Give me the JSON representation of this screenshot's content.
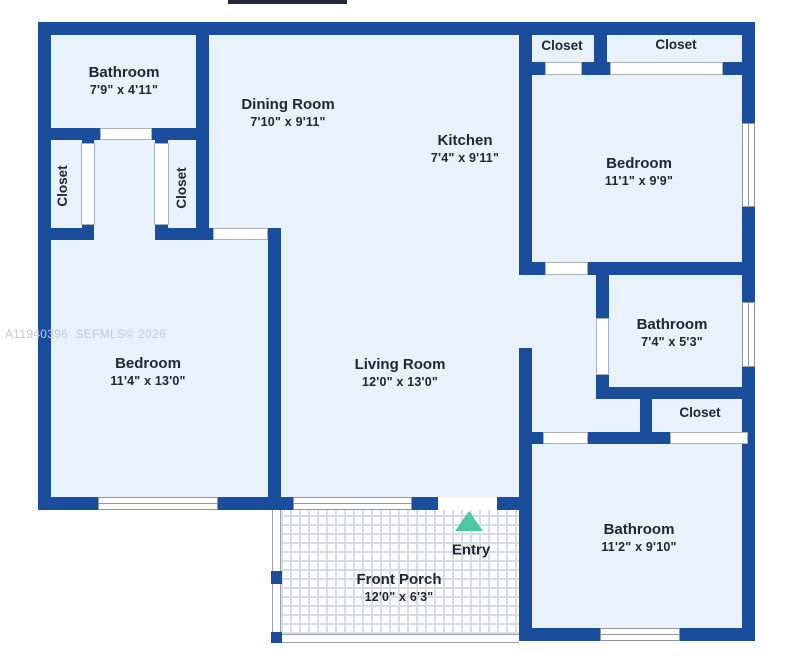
{
  "watermark": "A11940396  SEFMLS© 2026",
  "entry": {
    "label": "Entry"
  },
  "icons": {
    "entry_arrow": "triangle-up"
  },
  "colors": {
    "wall": "#1a4e9c",
    "floor": "#e9f1fa",
    "entry_arrow": "#4ec7a5",
    "label_text": "#202737"
  },
  "rooms": {
    "bathroom_top_left": {
      "name": "Bathroom",
      "dims": "7'9\" x 4'11\""
    },
    "dining_room": {
      "name": "Dining Room",
      "dims": "7'10\" x 9'11\""
    },
    "kitchen": {
      "name": "Kitchen",
      "dims": "7'4\" x 9'11\""
    },
    "closet_top_small": {
      "name": "Closet"
    },
    "closet_top_large": {
      "name": "Closet"
    },
    "bedroom_right": {
      "name": "Bedroom",
      "dims": "11'1\" x 9'9\""
    },
    "bathroom_middle": {
      "name": "Bathroom",
      "dims": "7'4\" x 5'3\""
    },
    "closet_middle": {
      "name": "Closet"
    },
    "closet_left_outer": {
      "name": "Closet"
    },
    "closet_left_inner": {
      "name": "Closet"
    },
    "bedroom_left": {
      "name": "Bedroom",
      "dims": "11'4\" x 13'0\""
    },
    "living_room": {
      "name": "Living Room",
      "dims": "12'0\" x 13'0\""
    },
    "bathroom_bottom": {
      "name": "Bathroom",
      "dims": "11'2\" x 9'10\""
    },
    "front_porch": {
      "name": "Front Porch",
      "dims": "12'0\" x 6'3\""
    }
  }
}
